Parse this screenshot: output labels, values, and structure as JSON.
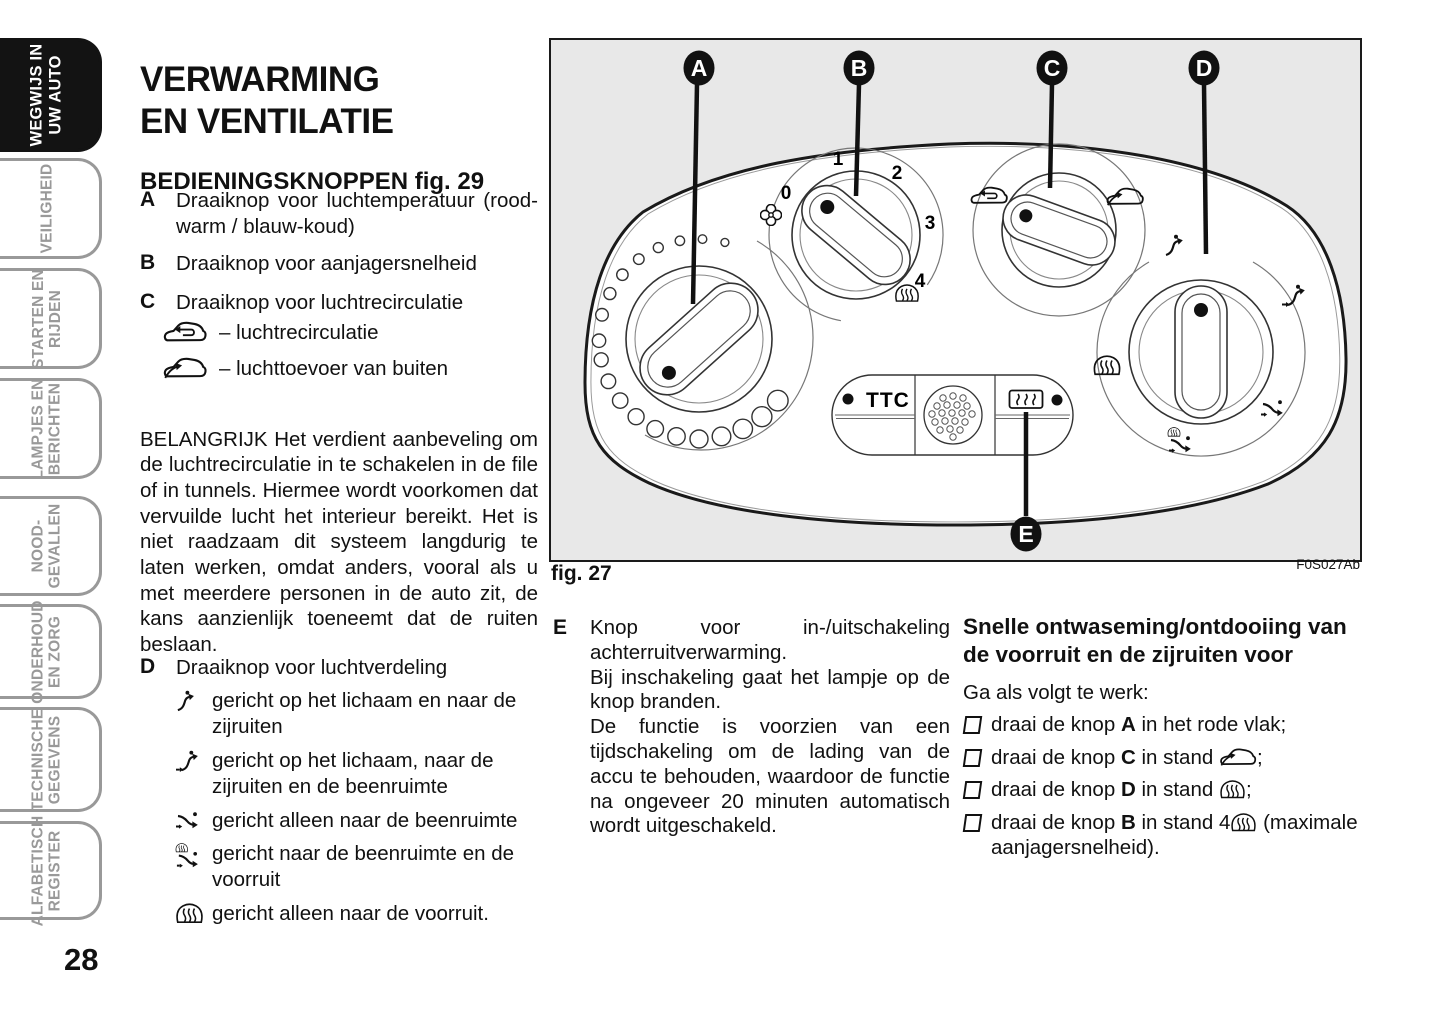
{
  "page": {
    "number": "28"
  },
  "sidebar": {
    "tabs": [
      {
        "line1": "WEGWIJS IN",
        "line2": "UW AUTO",
        "active": true
      },
      {
        "line1": "VEILIGHEID",
        "line2": ""
      },
      {
        "line1": "STARTEN EN",
        "line2": "RIJDEN"
      },
      {
        "line1": "LAMPJES EN",
        "line2": "BERICHTEN"
      },
      {
        "line1": "NOOD-",
        "line2": "GEVALLEN"
      },
      {
        "line1": "ONDERHOUD",
        "line2": "EN ZORG"
      },
      {
        "line1": "TECHNISCHE",
        "line2": "GEGEVENS"
      },
      {
        "line1": "ALFABETISCH",
        "line2": "REGISTER"
      }
    ]
  },
  "title": {
    "line1": "VERWARMING",
    "line2": "EN VENTILATIE"
  },
  "controls": {
    "heading": "BEDIENINGSKNOPPEN fig. 29",
    "item_a": {
      "letter": "A",
      "text": "Draaiknop voor luchtemperatuur (rood-warm / blauw-koud)"
    },
    "item_b": {
      "letter": "B",
      "text": "Draaiknop voor aanjagersnelheid"
    },
    "item_c": {
      "letter": "C",
      "text": "Draaiknop voor luchtrecirculatie",
      "sub1": {
        "icon": "recirculation-car-icon",
        "text": "– luchtrecirculatie"
      },
      "sub2": {
        "icon": "outside-air-car-icon",
        "text": "– luchttoevoer van buiten"
      }
    },
    "important": "BELANGRIJK Het verdient aanbeveling om de luchtrecirculatie in te schakelen in de file of in tunnels. Hiermee wordt voorkomen dat vervuilde lucht het interieur bereikt. Het is niet raadzaam dit systeem langdurig te laten werken, omdat anders, vooral als u met meerdere personen in de auto zit, de kans aanzienlijk toeneemt dat de ruiten beslaan.",
    "item_d": {
      "letter": "D",
      "text": "Draaiknop voor luchtverdeling",
      "sub1": {
        "icon": "air-body-side-windows-icon",
        "text": "gericht op het lichaam en naar de zijruiten"
      },
      "sub2": {
        "icon": "air-body-side-windows-feet-icon",
        "text": "gericht op het lichaam, naar de zijruiten en de beenruimte"
      },
      "sub3": {
        "icon": "air-feet-icon",
        "text": "gericht alleen naar de beenruimte"
      },
      "sub4": {
        "icon": "air-feet-windshield-icon",
        "text": "gericht naar de beenruimte en de voorruit"
      },
      "sub5": {
        "icon": "windshield-defrost-icon",
        "text": "gericht alleen naar de voorruit."
      }
    },
    "item_e": {
      "letter": "E",
      "p1": "Knop voor in-/uitschakeling achterruitverwarming.",
      "p2": "Bij inschakeling gaat het lampje op de knop branden.",
      "p3": "De functie is voorzien van een tijdschakeling om de lading van de accu te behouden, waardoor de functie na ongeveer 20 minuten automatisch wordt uitgeschakeld."
    }
  },
  "figure": {
    "caption": "fig. 27",
    "code": "F0S027Ab",
    "callout_a": "A",
    "callout_b": "B",
    "callout_c": "C",
    "callout_d": "D",
    "callout_e": "E",
    "fan_speeds": {
      "s0": "0",
      "s1": "1",
      "s2": "2",
      "s3": "3",
      "s4": "4"
    },
    "ttc_label": "TTC"
  },
  "defrost": {
    "heading": "Snelle ontwaseming/ontdooiing van de voorruit en de zijruiten voor",
    "intro": "Ga als volgt te werk:",
    "step1": {
      "pre": "draai de knop",
      "knob": "A",
      "post": "in het rode vlak;"
    },
    "step2": {
      "pre": "draai de knop",
      "knob": "C",
      "post": "in stand",
      "icon": "outside-air-car-icon",
      "suffix": ";"
    },
    "step3": {
      "pre": "draai de knop",
      "knob": "D",
      "post": "in stand",
      "icon": "windshield-defrost-icon",
      "suffix": ";"
    },
    "step4": {
      "pre": "draai de knop",
      "knob": "B",
      "post": "in stand 4",
      "icon": "windshield-defrost-icon",
      "suffix": "(maximale aanjagersnelheid)."
    }
  },
  "icons": {
    "recirculation-car-icon": "car silhouette with interior loop arrow",
    "outside-air-car-icon": "car silhouette with incoming air arrow",
    "air-body-side-windows-icon": "arrow toward upper body with head dot",
    "air-body-side-windows-feet-icon": "arrows toward body and feet",
    "air-feet-icon": "arrow toward footwell",
    "air-feet-windshield-icon": "arrows toward footwell and windshield",
    "windshield-defrost-icon": "windshield with three wavy defrost arrows",
    "fan-icon": "four-lobe fan clover",
    "rear-window-heat-icon": "rectangle with three wavy heat arrows",
    "speaker-grille-icon": "perforated round speaker grille",
    "checkbox-bullet-icon": "small open square"
  },
  "colors": {
    "ink": "#111111",
    "figure_bg": "#e8e8e8",
    "tab_gray": "#999999"
  }
}
